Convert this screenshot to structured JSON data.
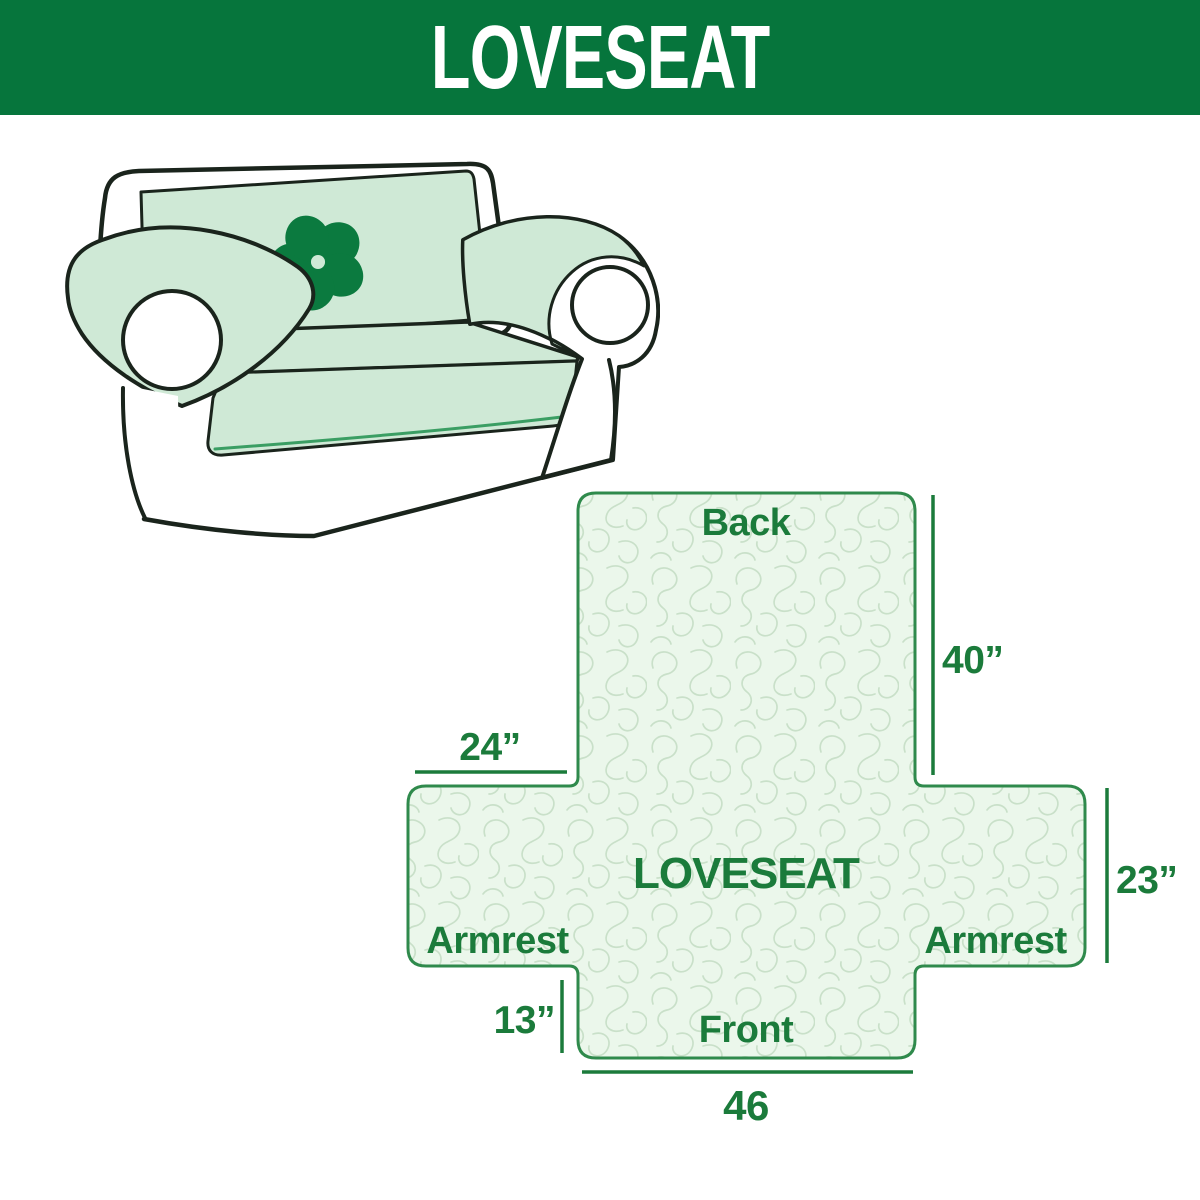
{
  "header": {
    "title": "LOVESEAT"
  },
  "sofa_illustration": {
    "alt": "line drawing of a two-seat loveseat sofa with a light green protective slipcover",
    "logo_icon": "pinwheel"
  },
  "diagram": {
    "labels": {
      "back": "Back",
      "front": "Front",
      "armrest_left": "Armrest",
      "armrest_right": "Armrest",
      "center": "LOVESEAT"
    },
    "dimensions": {
      "back_height": "40”",
      "armrest_top_width": "24”",
      "side_height": "23”",
      "front_drop": "13”",
      "bottom_width": "46"
    }
  },
  "colors": {
    "header_bg": "#06753C",
    "header_text": "#FFFFFF",
    "accent_green_text": "#1B7B3B",
    "diagram_border": "#2F8A4C",
    "diagram_fill": "#EBF7EB",
    "quilt_line": "#C9E0C9",
    "cover_green": "#CFE9D6",
    "cover_edge_green": "#3A9E63",
    "sofa_outline": "#1A241C",
    "logo_green": "#0B7A3F"
  }
}
